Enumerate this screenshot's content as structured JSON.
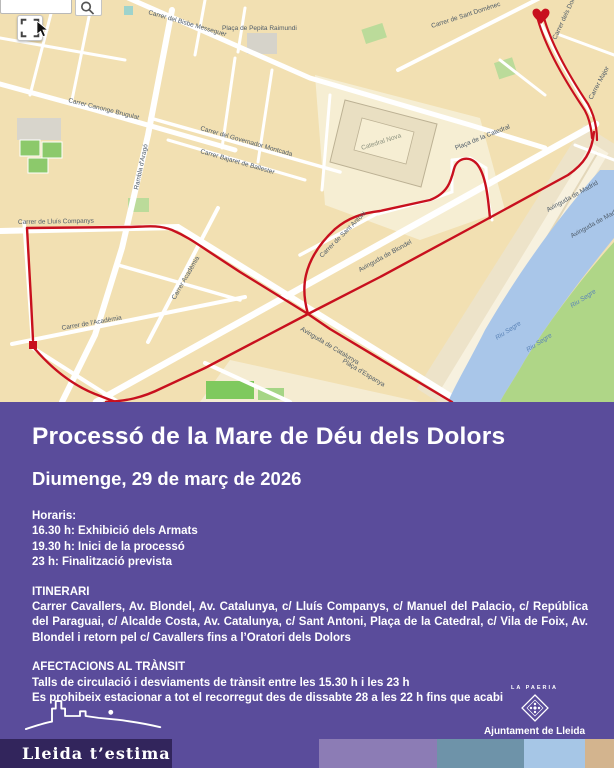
{
  "colors": {
    "purple": "#5A4C9B",
    "deep_purple": "#32255C",
    "route_red": "#C8101E",
    "river_blue": "#A9C6E9",
    "map_block_tan": "#F2E0B2"
  },
  "map": {
    "start_marker": "heart-marker",
    "end_marker": "square-marker",
    "labels": [
      {
        "t": "Carrer del Bisbe Messeguer",
        "x": 148,
        "y": 14,
        "r": 16
      },
      {
        "t": "Plaça de Pepita Raimundi",
        "x": 222,
        "y": 30,
        "r": 0,
        "s": 5.5
      },
      {
        "t": "Carrer de Sant Domènec",
        "x": 432,
        "y": 28,
        "r": -18
      },
      {
        "t": "Carrer dels Dolors",
        "x": 556,
        "y": 40,
        "r": -65,
        "s": 5.5
      },
      {
        "t": "Carrer Major",
        "x": 592,
        "y": 100,
        "r": -62,
        "s": 5.5
      },
      {
        "t": "Catedral Nova",
        "x": 362,
        "y": 150,
        "r": -18,
        "c": "poi"
      },
      {
        "t": "Plaça de la Catedral",
        "x": 456,
        "y": 150,
        "r": -22,
        "s": 5.5
      },
      {
        "t": "Carrer Canonge Brugulat",
        "x": 68,
        "y": 102,
        "r": 14
      },
      {
        "t": "Carrer del Governador Montcada",
        "x": 200,
        "y": 130,
        "r": 16,
        "s": 5.5
      },
      {
        "t": "Carrer Bajaret de Ballester",
        "x": 200,
        "y": 153,
        "r": 16,
        "s": 5.5
      },
      {
        "t": "Rambla d'Aragó",
        "x": 138,
        "y": 190,
        "r": -78
      },
      {
        "t": "Carrer de Lluís Companys",
        "x": 18,
        "y": 224,
        "r": -1
      },
      {
        "t": "Carrer Acadèmia",
        "x": 175,
        "y": 300,
        "r": -60
      },
      {
        "t": "Carrer de l'Acadèmia",
        "x": 62,
        "y": 330,
        "r": -10
      },
      {
        "t": "Carrer de Sant Antoni",
        "x": 322,
        "y": 258,
        "r": -45,
        "s": 5.5
      },
      {
        "t": "Avinguda de Blondel",
        "x": 360,
        "y": 272,
        "r": -29
      },
      {
        "t": "Avinguda de Madrid",
        "x": 548,
        "y": 212,
        "r": -29,
        "s": 5.5
      },
      {
        "t": "Avinguda de Madrid",
        "x": 572,
        "y": 238,
        "r": -29,
        "s": 5.5
      },
      {
        "t": "Avinguda de Catalunya",
        "x": 300,
        "y": 330,
        "r": 31,
        "s": 5.5
      },
      {
        "t": "Plaça d'Espanya",
        "x": 342,
        "y": 362,
        "r": 31,
        "s": 5.5
      },
      {
        "t": "Riu Segre",
        "x": 497,
        "y": 340,
        "r": -33,
        "c": "water"
      },
      {
        "t": "Riu Segre",
        "x": 528,
        "y": 352,
        "r": -33,
        "c": "water"
      },
      {
        "t": "Riu Segre",
        "x": 572,
        "y": 308,
        "r": -33,
        "c": "water"
      }
    ]
  },
  "poster": {
    "title": "Processó de la Mare de Déu dels Dolors",
    "date": "Diumenge, 29 de març de 2026",
    "schedule": {
      "heading": "Horaris:",
      "items": [
        "16.30 h: Exhibició dels Armats",
        "19.30 h: Inici de la processó",
        "23 h: Finalització prevista"
      ]
    },
    "itinerary": {
      "heading": "ITINERARI",
      "text": "Carrer Cavallers, Av. Blondel, Av. Catalunya, c/ Lluís Companys, c/ Manuel del Palacio, c/ República del Paraguai, c/ Alcalde Costa, Av. Catalunya, c/ Sant Antoni, Plaça de la Catedral, c/ Vila de Foix, Av. Blondel i retorn pel c/ Cavallers fins a l’Oratori dels Dolors"
    },
    "traffic": {
      "heading": "AFECTACIONS AL TRÀNSIT",
      "lines": [
        "Talls de circulació i desviaments de trànsit entre les 15.30 h i les 23 h",
        "Es prohibeix estacionar a tot el recorregut des de dissabte 28 a les 22 h fins que acabi"
      ]
    }
  },
  "footer": {
    "lleida_logo": "Lleida t’estima",
    "paeria_label": "LA PAERIA",
    "ajuntament": "Ajuntament de Lleida",
    "palette": [
      "#8C7CB5",
      "#6E93A9",
      "#A6C6E6",
      "#D3B48E"
    ]
  }
}
